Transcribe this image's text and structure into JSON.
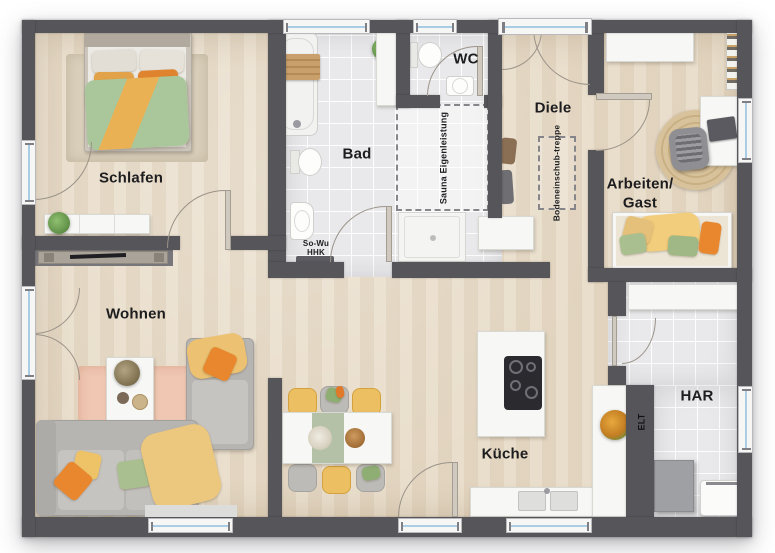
{
  "plan_title": "Erdgeschoss Grundriss",
  "rooms": {
    "schlafen": {
      "label": "Schlafen"
    },
    "bad": {
      "label": "Bad"
    },
    "wc": {
      "label": "WC"
    },
    "diele": {
      "label": "Diele"
    },
    "arbeiten_gast": {
      "line1": "Arbeiten/",
      "line2": "Gast"
    },
    "wohnen": {
      "label": "Wohnen"
    },
    "kueche": {
      "label": "Küche"
    },
    "har": {
      "label": "HAR"
    }
  },
  "annotations": {
    "sauna": {
      "line1": "Sauna",
      "line2": "Eigenleistung"
    },
    "treppe": {
      "line1": "Bodeneinschub-",
      "line2": "treppe"
    },
    "sowu": {
      "line1": "So-Wu",
      "line2": "HHK"
    },
    "elt": {
      "label": "ELT"
    }
  },
  "colors": {
    "wall": "#55555a",
    "wood": "#e7dac5",
    "tile": "#e9e9eb",
    "glass": "#a9cde4",
    "accent_orange": "#e8872e",
    "accent_yellow": "#eec266",
    "accent_green": "#a9bf8f",
    "rug_pink": "#efc7b2",
    "rug_jute": "#d8c29b"
  }
}
